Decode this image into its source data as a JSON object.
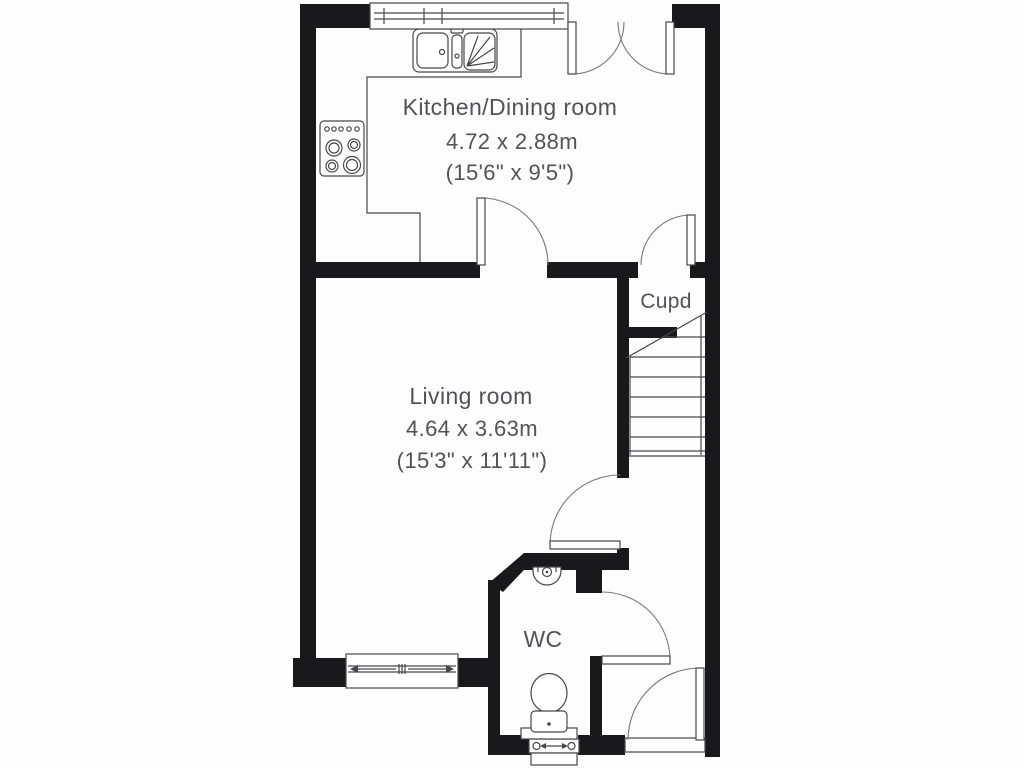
{
  "plan": {
    "rooms": [
      {
        "id": "kitchen-dining",
        "name": "Kitchen/Dining room",
        "size_m": "4.72 x 2.88m",
        "size_ft": "(15'6\" x 9'5\")"
      },
      {
        "id": "living-room",
        "name": "Living room",
        "size_m": "4.64 x 3.63m",
        "size_ft": "(15'3\" x 11'11\")"
      },
      {
        "id": "cupboard",
        "name": "Cupd"
      },
      {
        "id": "wc",
        "name": "WC"
      }
    ],
    "fixtures": [
      "kitchen-sink",
      "hob",
      "staircase",
      "wash-basin",
      "toilet"
    ],
    "features": [
      "window",
      "french-doors",
      "internal-doors",
      "front-door"
    ],
    "colors": {
      "wall": "#19191b",
      "line": "#47474b",
      "arc": "#77777b",
      "text": "#525257",
      "background": "#fdfdfd"
    }
  }
}
